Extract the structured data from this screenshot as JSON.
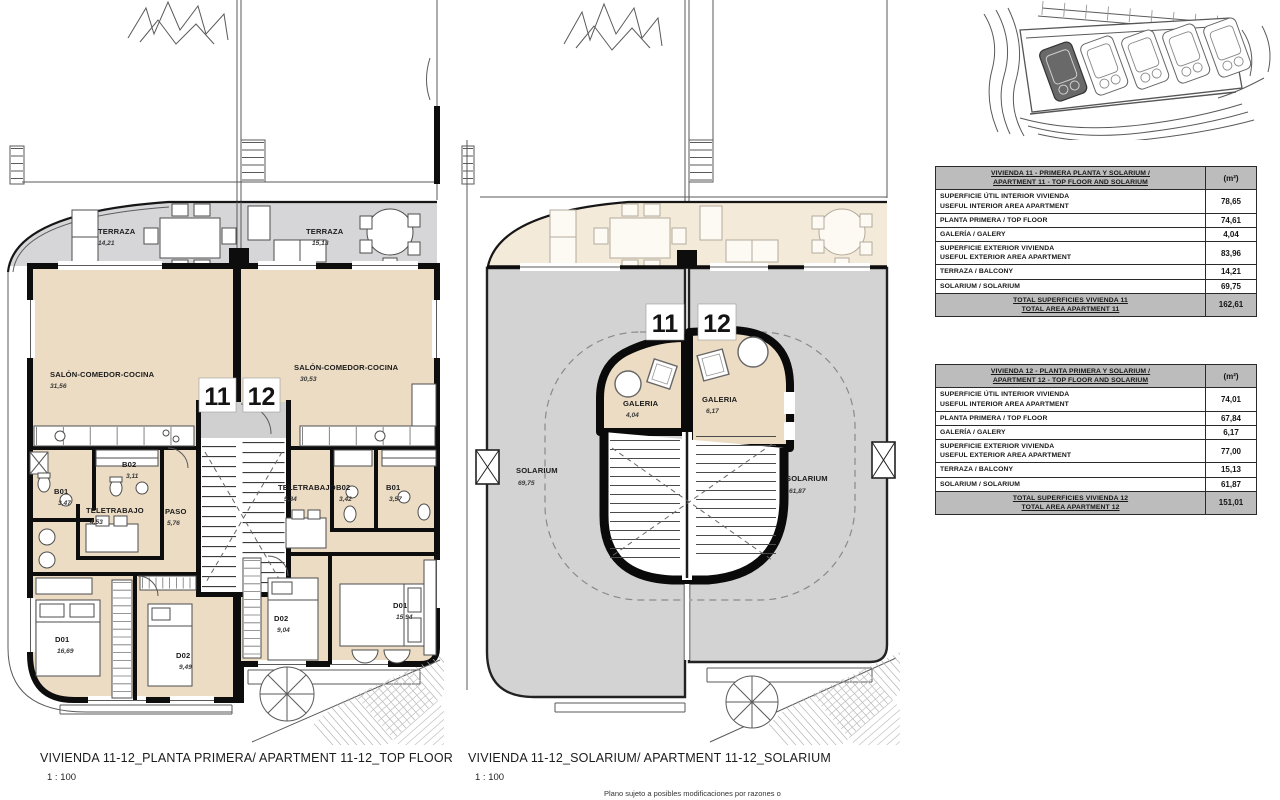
{
  "colors": {
    "interior_beige": "#ecdcc3",
    "terrace_gray": "#d6d6d8",
    "terrace_cream": "#f3ead9",
    "solarium_gray": "#d3d3d3",
    "wall_black": "#0d0d0d",
    "table_header_gray": "#bcbcbc",
    "site_highlight": "#696969"
  },
  "plans": {
    "top_floor": {
      "caption": "VIVIENDA 11-12_PLANTA PRIMERA/ APARTMENT 11-12_TOP FLOOR",
      "scale": "1 : 100",
      "unit_badges": {
        "left": "11",
        "right": "12"
      },
      "rooms": {
        "terraza_11": {
          "label": "TERRAZA",
          "area": "14,21"
        },
        "terraza_12": {
          "label": "TERRAZA",
          "area": "15,13"
        },
        "salon_11": {
          "label": "SALÓN-COMEDOR-COCINA",
          "area": "31,56"
        },
        "salon_12": {
          "label": "SALÓN-COMEDOR-COCINA",
          "area": "30,53"
        },
        "b02_11": {
          "label": "B02",
          "area": "3,11"
        },
        "b01_11": {
          "label": "B01",
          "area": "3,47"
        },
        "teletrabajo_11": {
          "label": "TELETRABAJO",
          "area": "4,53"
        },
        "paso_11": {
          "label": "PASO",
          "area": "5,76"
        },
        "teletrabajo_12": {
          "label": "TELETRABAJO",
          "area": "5,34"
        },
        "b02_12": {
          "label": "B02",
          "area": "3,42"
        },
        "b01_12": {
          "label": "B01",
          "area": "3,57"
        },
        "d01_11": {
          "label": "D01",
          "area": "16,69"
        },
        "d02_11": {
          "label": "D02",
          "area": "9,49"
        },
        "d02_12": {
          "label": "D02",
          "area": "9,04"
        },
        "d01_12": {
          "label": "D01",
          "area": "15,94"
        }
      }
    },
    "solarium": {
      "caption": "VIVIENDA 11-12_SOLARIUM/ APARTMENT 11-12_SOLARIUM",
      "scale": "1 : 100",
      "unit_badges": {
        "left": "11",
        "right": "12"
      },
      "rooms": {
        "galeria_11": {
          "label": "GALERIA",
          "area": "4,04"
        },
        "galeria_12": {
          "label": "GALERIA",
          "area": "6,17"
        },
        "solarium_11": {
          "label": "SOLARIUM",
          "area": "69,75"
        },
        "solarium_12": {
          "label": "SOLARIUM",
          "area": "61,87"
        }
      }
    }
  },
  "tables": {
    "t11": {
      "title_l1": "VIVIENDA 11 - PRIMERA PLANTA Y SOLARIUM /",
      "title_l2": "APARTMENT 11 - TOP FLOOR AND SOLARIUM",
      "unit": "(m²)",
      "rows": [
        {
          "l1": "SUPERFICIE ÚTIL INTERIOR VIVIENDA",
          "l2": "USEFUL INTERIOR AREA APARTMENT",
          "v": "78,65"
        },
        {
          "l1": "PLANTA PRIMERA / TOP FLOOR",
          "v": "74,61"
        },
        {
          "l1": "GALERÍA / GALERY",
          "v": "4,04"
        },
        {
          "l1": "SUPERFICIE EXTERIOR VIVIENDA",
          "l2": "USEFUL EXTERIOR AREA APARTMENT",
          "v": "83,96"
        },
        {
          "l1": "TERRAZA / BALCONY",
          "v": "14,21"
        },
        {
          "l1": "SOLARIUM / SOLARIUM",
          "v": "69,75"
        }
      ],
      "total_l1": "TOTAL SUPERFICIES VIVIENDA 11",
      "total_l2": "TOTAL AREA APARTMENT 11",
      "total_v": "162,61"
    },
    "t12": {
      "title_l1": "VIVIENDA 12 - PLANTA PRIMERA Y SOLARIUM /",
      "title_l2": "APARTMENT 12 - TOP FLOOR AND SOLARIUM",
      "unit": "(m²)",
      "rows": [
        {
          "l1": "SUPERFICIE ÚTIL INTERIOR VIVIENDA",
          "l2": "USEFUL INTERIOR AREA APARTMENT",
          "v": "74,01"
        },
        {
          "l1": "PLANTA PRIMERA / TOP FLOOR",
          "v": "67,84"
        },
        {
          "l1": "GALERÍA / GALERY",
          "v": "6,17"
        },
        {
          "l1": "SUPERFICIE EXTERIOR VIVIENDA",
          "l2": "USEFUL EXTERIOR AREA APARTMENT",
          "v": "77,00"
        },
        {
          "l1": "TERRAZA / BALCONY",
          "v": "15,13"
        },
        {
          "l1": "SOLARIUM / SOLARIUM",
          "v": "61,87"
        }
      ],
      "total_l1": "TOTAL SUPERFICIES VIVIENDA 12",
      "total_l2": "TOTAL AREA APARTMENT 12",
      "total_v": "151,01"
    }
  },
  "footer": {
    "note": "Plano sujeto a posibles modificaciones por razones o"
  }
}
